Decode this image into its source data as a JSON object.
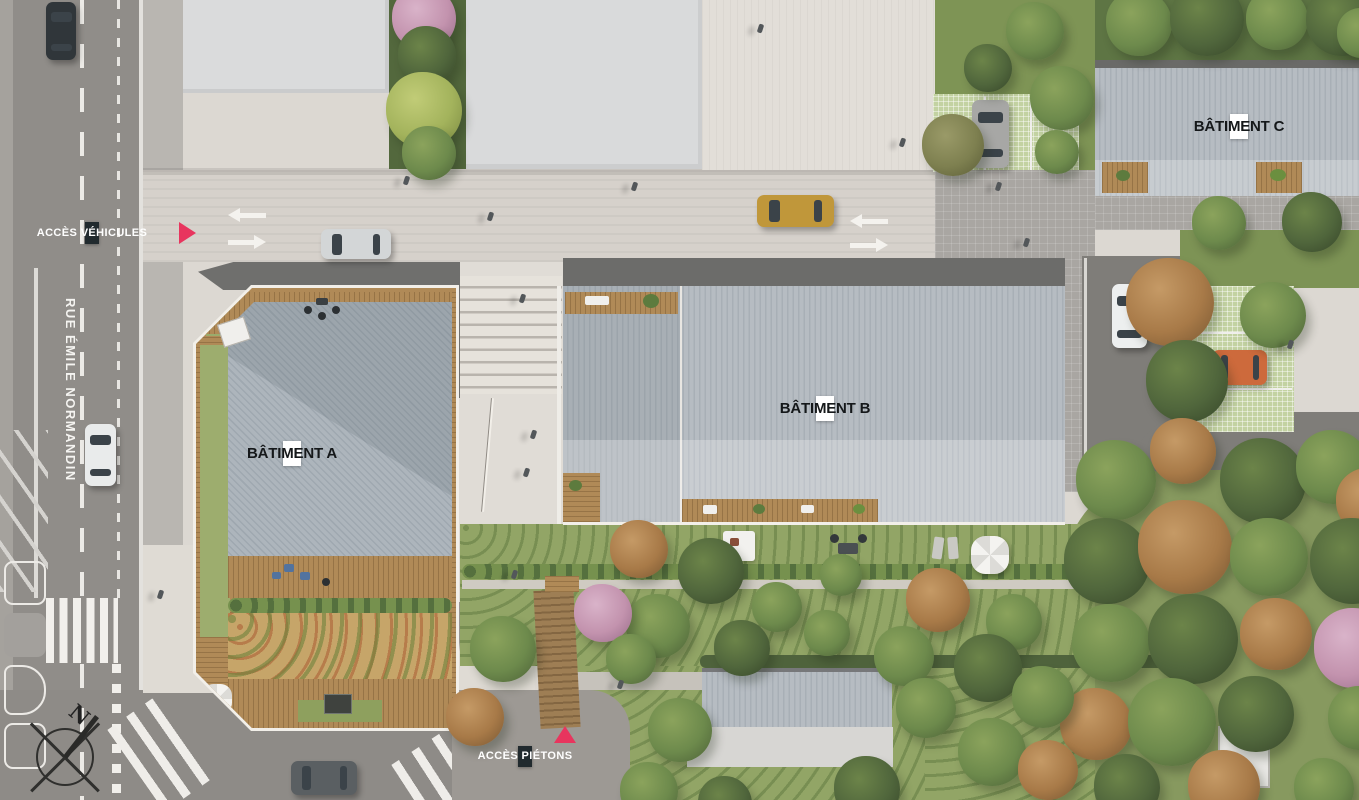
{
  "plan": {
    "street_name": "RUE ÉMILE NORMANDIN",
    "labels": {
      "access_vehicles": "ACCÈS VÉHICULES",
      "access_pedestrians": "ACCÈS PIÉTONS",
      "building_a": "BÂTIMENT A",
      "building_b": "BÂTIMENT B",
      "building_c": "BÂTIMENT C",
      "compass_north": "N"
    },
    "colors": {
      "accent": "#e8355e",
      "label_dark_bg": "#212a2e",
      "label_light_bg": "#ffffff",
      "asphalt": "#908d89",
      "metal_roof": "#b2b9bf",
      "wood_deck": "#b08a57",
      "lawn": "#8fa360"
    }
  }
}
